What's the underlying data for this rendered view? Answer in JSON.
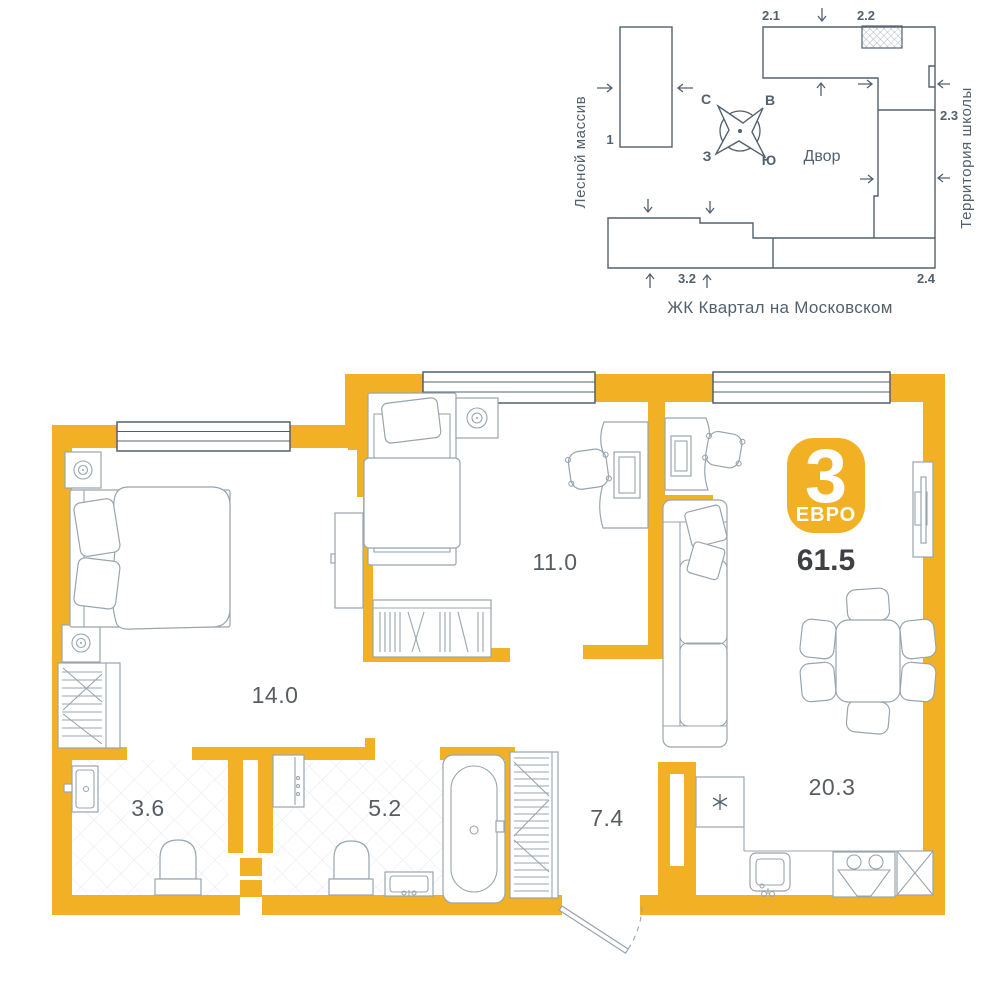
{
  "site_plan": {
    "building_labels": {
      "b1": "1",
      "b2_1": "2.1",
      "b2_2": "2.2",
      "b2_3": "2.3",
      "b2_4": "2.4",
      "b3_2": "3.2"
    },
    "compass": {
      "north": "С",
      "east": "В",
      "west": "З",
      "south": "Ю"
    },
    "courtyard": "Двор",
    "left_area": "Лесной массив",
    "right_area": "Территория школы",
    "title": "ЖК Квартал на Московском"
  },
  "apartment": {
    "badge_rooms": "3",
    "badge_type": "ЕВРО",
    "total_area": "61.5",
    "room_areas": {
      "bedroom_main": "14.0",
      "bedroom_second": "11.0",
      "bathroom_small": "3.6",
      "bathroom_large": "5.2",
      "hallway": "7.4",
      "kitchen_living": "20.3"
    }
  },
  "colors": {
    "accent": "#F2B124",
    "plan_line": "#53616D",
    "furniture_line": "#98A5AE",
    "label_text": "#595D61",
    "value_text": "#3E4043"
  }
}
